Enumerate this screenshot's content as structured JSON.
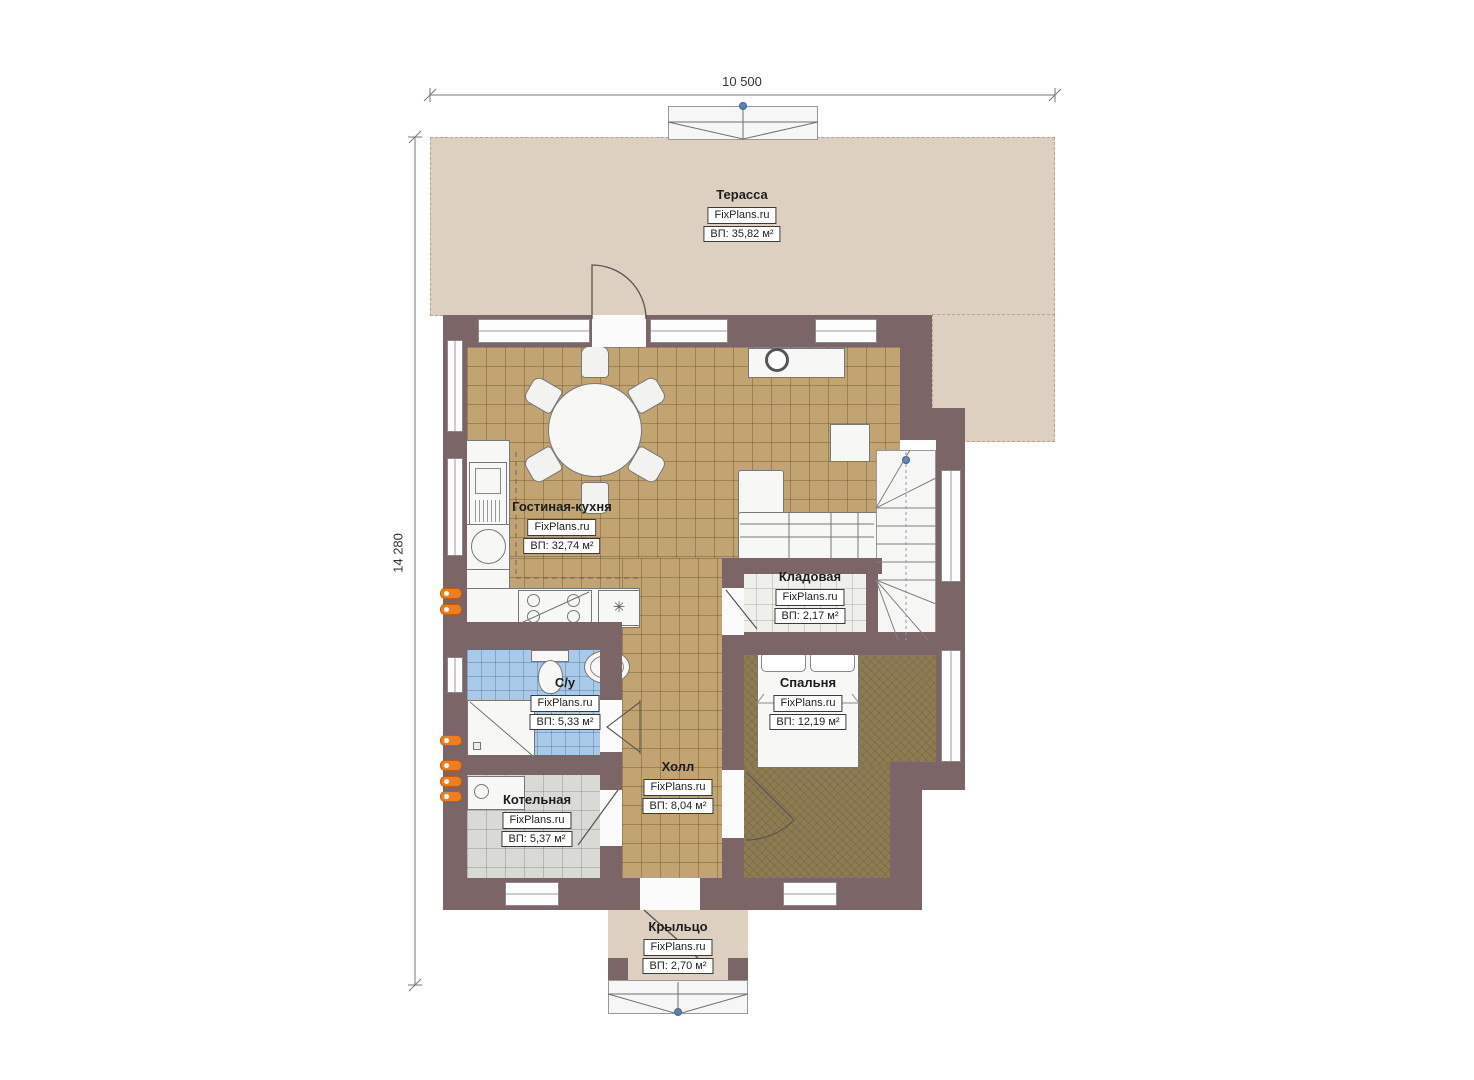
{
  "plan_title": "Floor plan",
  "dimensions": {
    "width_label": "10 500",
    "height_label": "14 280"
  },
  "rooms": {
    "terrace": {
      "name": "Терасса",
      "brand": "FixPlans.ru",
      "area": "ВП: 35,82 м²"
    },
    "living_kitchen": {
      "name": "Гостиная-кухня",
      "brand": "FixPlans.ru",
      "area": "ВП: 32,74 м²"
    },
    "storage": {
      "name": "Кладовая",
      "brand": "FixPlans.ru",
      "area": "ВП: 2,17 м²"
    },
    "bathroom": {
      "name": "С/у",
      "brand": "FixPlans.ru",
      "area": "ВП: 5,33 м²"
    },
    "bedroom": {
      "name": "Спальня",
      "brand": "FixPlans.ru",
      "area": "ВП: 12,19 м²"
    },
    "hall": {
      "name": "Холл",
      "brand": "FixPlans.ru",
      "area": "ВП: 8,04 м²"
    },
    "boiler": {
      "name": "Котельная",
      "brand": "FixPlans.ru",
      "area": "ВП: 5,37 м²"
    },
    "porch": {
      "name": "Крыльцо",
      "brand": "FixPlans.ru",
      "area": "ВП: 2,70 м²"
    }
  },
  "symbols": {
    "appliance_star": "✳"
  },
  "colors": {
    "wall": "#7b6566",
    "terrace_floor": "#ddd0c1",
    "living_tile": "#c1a471",
    "bathroom_tile": "#a9c9e9",
    "boiler_tile": "#d9d9d6",
    "bedroom_carpet": "#8d7b52",
    "radiator": "#f07d1e",
    "level_marker": "#5b84b9"
  }
}
